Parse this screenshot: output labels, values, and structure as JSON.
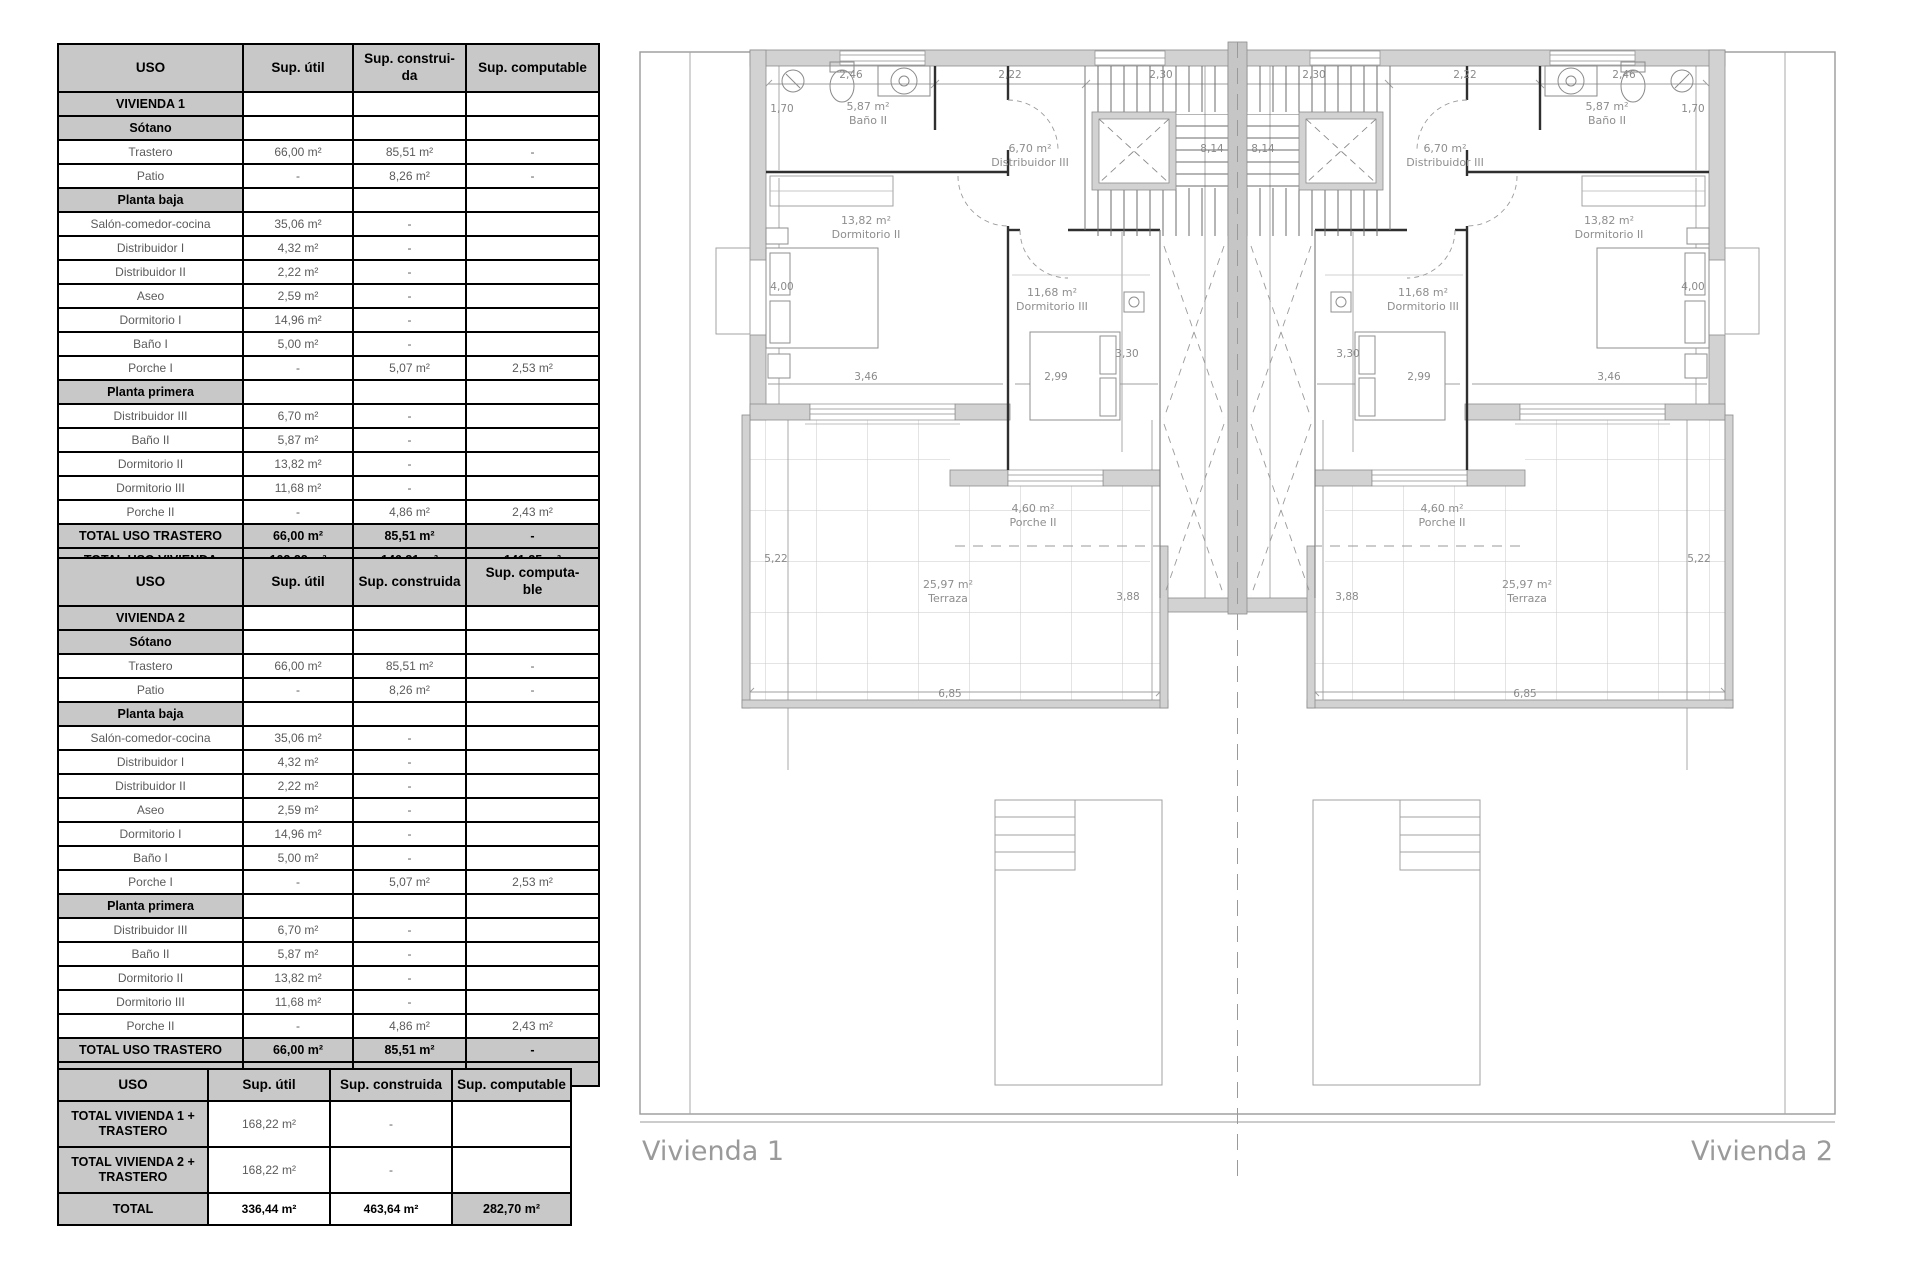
{
  "colors": {
    "table_header_bg": "#c8c8c8",
    "table_border": "#000000",
    "plan_wall": "#d2d2d2",
    "plan_line": "#9a9a9a",
    "plan_text": "#8e8e8e"
  },
  "tables": [
    {
      "name": "vivienda1",
      "header": [
        "USO",
        "Sup. útil",
        "Sup. construi-\nda",
        "Sup. computable"
      ],
      "rows": [
        {
          "t": "section",
          "c": [
            "VIVIENDA 1",
            "",
            "",
            ""
          ]
        },
        {
          "t": "section",
          "c": [
            "Sótano",
            "",
            "",
            ""
          ]
        },
        {
          "t": "data",
          "c": [
            "Trastero",
            "66,00 m²",
            "85,51 m²",
            "-"
          ]
        },
        {
          "t": "data",
          "c": [
            "Patio",
            "-",
            "8,26 m²",
            "-"
          ]
        },
        {
          "t": "section",
          "c": [
            "Planta baja",
            "",
            "",
            ""
          ]
        },
        {
          "t": "data",
          "c": [
            "Salón-comedor-cocina",
            "35,06 m²",
            "-",
            ""
          ]
        },
        {
          "t": "data",
          "c": [
            "Distribuidor I",
            "4,32 m²",
            "-",
            ""
          ]
        },
        {
          "t": "data",
          "c": [
            "Distribuidor II",
            "2,22 m²",
            "-",
            ""
          ]
        },
        {
          "t": "data",
          "c": [
            "Aseo",
            "2,59 m²",
            "-",
            ""
          ]
        },
        {
          "t": "data",
          "c": [
            "Dormitorio I",
            "14,96 m²",
            "-",
            ""
          ]
        },
        {
          "t": "data",
          "c": [
            "Baño I",
            "5,00 m²",
            "-",
            ""
          ]
        },
        {
          "t": "data",
          "c": [
            "Porche I",
            "-",
            "5,07 m²",
            "2,53 m²"
          ]
        },
        {
          "t": "section",
          "c": [
            "Planta primera",
            "",
            "",
            ""
          ]
        },
        {
          "t": "data",
          "c": [
            "Distribuidor III",
            "6,70 m²",
            "-",
            ""
          ]
        },
        {
          "t": "data",
          "c": [
            "Baño II",
            "5,87 m²",
            "-",
            ""
          ]
        },
        {
          "t": "data",
          "c": [
            "Dormitorio II",
            "13,82 m²",
            "-",
            ""
          ]
        },
        {
          "t": "data",
          "c": [
            "Dormitorio III",
            "11,68 m²",
            "-",
            ""
          ]
        },
        {
          "t": "data",
          "c": [
            "Porche II",
            "-",
            "4,86 m²",
            "2,43 m²"
          ]
        },
        {
          "t": "total",
          "c": [
            "TOTAL USO TRASTERO",
            "66,00 m²",
            "85,51 m²",
            "-"
          ]
        },
        {
          "t": "total",
          "c": [
            "TOTAL USO VIVIENDA",
            "102,22 m²",
            "146,31 m²",
            "141,35 m²"
          ]
        }
      ]
    },
    {
      "name": "vivienda2",
      "header": [
        "USO",
        "Sup. útil",
        "Sup. construida",
        "Sup. computa-\nble"
      ],
      "rows": [
        {
          "t": "section",
          "c": [
            "VIVIENDA 2",
            "",
            "",
            ""
          ]
        },
        {
          "t": "section",
          "c": [
            "Sótano",
            "",
            "",
            ""
          ]
        },
        {
          "t": "data",
          "c": [
            "Trastero",
            "66,00 m²",
            "85,51 m²",
            "-"
          ]
        },
        {
          "t": "data",
          "c": [
            "Patio",
            "-",
            "8,26 m²",
            "-"
          ]
        },
        {
          "t": "section",
          "c": [
            "Planta baja",
            "",
            "",
            ""
          ]
        },
        {
          "t": "data",
          "c": [
            "Salón-comedor-cocina",
            "35,06 m²",
            "-",
            ""
          ]
        },
        {
          "t": "data",
          "c": [
            "Distribuidor I",
            "4,32 m²",
            "-",
            ""
          ]
        },
        {
          "t": "data",
          "c": [
            "Distribuidor II",
            "2,22 m²",
            "-",
            ""
          ]
        },
        {
          "t": "data",
          "c": [
            "Aseo",
            "2,59 m²",
            "-",
            ""
          ]
        },
        {
          "t": "data",
          "c": [
            "Dormitorio I",
            "14,96 m²",
            "-",
            ""
          ]
        },
        {
          "t": "data",
          "c": [
            "Baño I",
            "5,00 m²",
            "-",
            ""
          ]
        },
        {
          "t": "data",
          "c": [
            "Porche I",
            "-",
            "5,07 m²",
            "2,53 m²"
          ]
        },
        {
          "t": "section",
          "c": [
            "Planta primera",
            "",
            "",
            ""
          ]
        },
        {
          "t": "data",
          "c": [
            "Distribuidor III",
            "6,70 m²",
            "-",
            ""
          ]
        },
        {
          "t": "data",
          "c": [
            "Baño II",
            "5,87 m²",
            "-",
            ""
          ]
        },
        {
          "t": "data",
          "c": [
            "Dormitorio II",
            "13,82 m²",
            "-",
            ""
          ]
        },
        {
          "t": "data",
          "c": [
            "Dormitorio III",
            "11,68 m²",
            "-",
            ""
          ]
        },
        {
          "t": "data",
          "c": [
            "Porche II",
            "-",
            "4,86 m²",
            "2,43 m²"
          ]
        },
        {
          "t": "total",
          "c": [
            "TOTAL USO TRASTERO",
            "66,00 m²",
            "85,51 m²",
            "-"
          ]
        },
        {
          "t": "total",
          "c": [
            "TOTAL USO VIVIENDA",
            "102,22 m²",
            "146,31 m²",
            "141,35 m²"
          ]
        }
      ]
    },
    {
      "name": "totales",
      "header": [
        "USO",
        "Sup. útil",
        "Sup. construida",
        "Sup. computable"
      ],
      "rows": [
        {
          "t": "big",
          "c": [
            "TOTAL VIVIENDA 1 +\nTRASTERO",
            "168,22 m²",
            "-",
            ""
          ]
        },
        {
          "t": "big",
          "c": [
            "TOTAL VIVIENDA 2 +\nTRASTERO",
            "168,22 m²",
            "-",
            ""
          ]
        },
        {
          "t": "total3",
          "c": [
            "TOTAL",
            "336,44 m²",
            "463,64  m²",
            "282,70  m²"
          ]
        }
      ]
    }
  ],
  "plan": {
    "titles": [
      {
        "text": "Vivienda 1"
      },
      {
        "text": "Vivienda 2"
      }
    ],
    "room_labels": [
      {
        "x": 868,
        "y": 110,
        "l1": "5,87 m²",
        "l2": "Baño II"
      },
      {
        "x": 1030,
        "y": 152,
        "l1": "6,70 m²",
        "l2": "Distribuidor III"
      },
      {
        "x": 866,
        "y": 224,
        "l1": "13,82 m²",
        "l2": "Dormitorio II"
      },
      {
        "x": 1052,
        "y": 296,
        "l1": "11,68 m²",
        "l2": "Dormitorio III"
      },
      {
        "x": 1033,
        "y": 512,
        "l1": "4,60 m²",
        "l2": "Porche II"
      },
      {
        "x": 948,
        "y": 588,
        "l1": "25,97 m²",
        "l2": "Terraza"
      },
      {
        "x": 1607,
        "y": 110,
        "l1": "5,87 m²",
        "l2": "Baño II"
      },
      {
        "x": 1445,
        "y": 152,
        "l1": "6,70 m²",
        "l2": "Distribuidor III"
      },
      {
        "x": 1609,
        "y": 224,
        "l1": "13,82 m²",
        "l2": "Dormitorio II"
      },
      {
        "x": 1423,
        "y": 296,
        "l1": "11,68 m²",
        "l2": "Dormitorio III"
      },
      {
        "x": 1442,
        "y": 512,
        "l1": "4,60 m²",
        "l2": "Porche II"
      },
      {
        "x": 1527,
        "y": 588,
        "l1": "25,97 m²",
        "l2": "Terraza"
      }
    ],
    "dim_labels": [
      {
        "x": 851,
        "y": 78,
        "t": "2,46"
      },
      {
        "x": 1010,
        "y": 78,
        "t": "2,22"
      },
      {
        "x": 1161,
        "y": 78,
        "t": "2,30"
      },
      {
        "x": 782,
        "y": 112,
        "t": "1,70"
      },
      {
        "x": 782,
        "y": 290,
        "t": "4,00"
      },
      {
        "x": 1212,
        "y": 152,
        "t": "8,14"
      },
      {
        "x": 866,
        "y": 380,
        "t": "3,46"
      },
      {
        "x": 1056,
        "y": 380,
        "t": "2,99"
      },
      {
        "x": 1127,
        "y": 357,
        "t": "3,30"
      },
      {
        "x": 776,
        "y": 562,
        "t": "5,22"
      },
      {
        "x": 1128,
        "y": 600,
        "t": "3,88"
      },
      {
        "x": 950,
        "y": 697,
        "t": "6,85"
      },
      {
        "x": 1624,
        "y": 78,
        "t": "2,46"
      },
      {
        "x": 1465,
        "y": 78,
        "t": "2,22"
      },
      {
        "x": 1314,
        "y": 78,
        "t": "2,30"
      },
      {
        "x": 1693,
        "y": 112,
        "t": "1,70"
      },
      {
        "x": 1693,
        "y": 290,
        "t": "4,00"
      },
      {
        "x": 1263,
        "y": 152,
        "t": "8,14"
      },
      {
        "x": 1609,
        "y": 380,
        "t": "3,46"
      },
      {
        "x": 1419,
        "y": 380,
        "t": "2,99"
      },
      {
        "x": 1348,
        "y": 357,
        "t": "3,30"
      },
      {
        "x": 1699,
        "y": 562,
        "t": "5,22"
      },
      {
        "x": 1347,
        "y": 600,
        "t": "3,88"
      },
      {
        "x": 1525,
        "y": 697,
        "t": "6,85"
      }
    ]
  }
}
